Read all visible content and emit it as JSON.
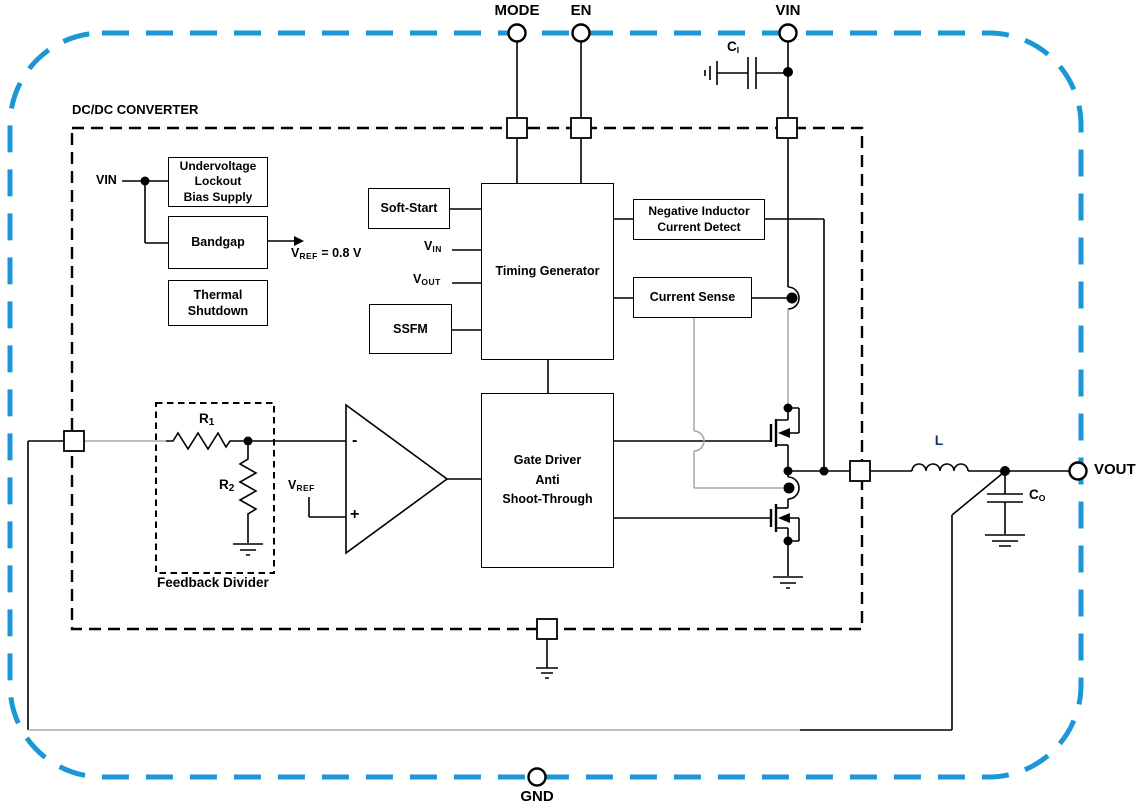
{
  "diagram": {
    "title": "DC/DC CONVERTER",
    "pins": {
      "mode": "MODE",
      "en": "EN",
      "vin": "VIN",
      "vout": "VOUT",
      "gnd": "GND"
    },
    "blocks": {
      "uvlo": "Undervoltage\nLockout\nBias Supply",
      "bandgap": "Bandgap",
      "thermal": "Thermal\nShutdown",
      "soft_start": "Soft-Start",
      "timing": "Timing Generator",
      "ssfm": "SSFM",
      "nicd": "Negative Inductor\nCurrent Detect",
      "current_sense": "Current Sense",
      "gate_driver": "Gate Driver\nAnti\nShoot-Through"
    },
    "labels": {
      "vin_internal": "VIN",
      "vref_eq": {
        "base": "V",
        "sub": "REF",
        "rest": " = 0.8 V"
      },
      "tg_vin": {
        "base": "V",
        "sub": "IN"
      },
      "tg_vout": {
        "base": "V",
        "sub": "OUT"
      },
      "comparator": {
        "minus": "-",
        "plus": "+",
        "vref": {
          "base": "V",
          "sub": "REF"
        }
      },
      "feedback_title": "Feedback Divider",
      "r1": {
        "base": "R",
        "sub": "1"
      },
      "r2": {
        "base": "R",
        "sub": "2"
      },
      "ci": {
        "base": "C",
        "sub": "I"
      },
      "co": {
        "base": "C",
        "sub": "O"
      },
      "inductor": "L"
    },
    "colors": {
      "boundary_blue": "#1b97d5",
      "wire_black": "#000000",
      "wire_gray": "#a6a6a6",
      "inductor_label_blue": "#17365d"
    }
  }
}
